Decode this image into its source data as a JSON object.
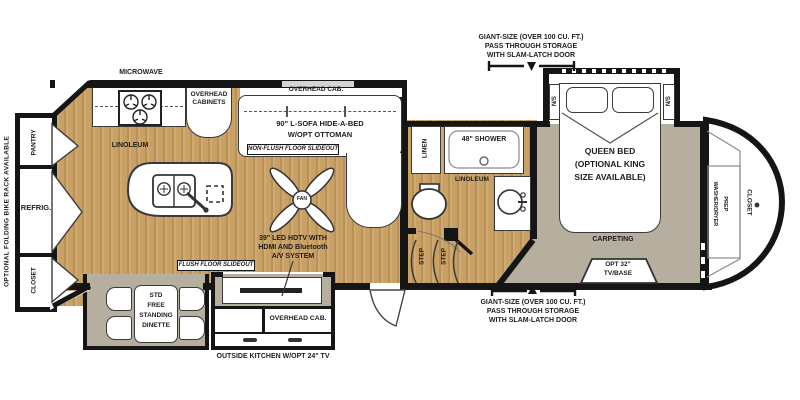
{
  "labels": {
    "microwave": "MICROWAVE",
    "overhead_cabinets_1": "OVERHEAD",
    "overhead_cabinets_2": "CABINETS",
    "overhead_cab_sofa": "OVERHEAD CAB.",
    "sofa_1": "90\" L-SOFA HIDE-A-BED",
    "sofa_2": "W/OPT OTTOMAN",
    "non_flush_slideout": "NON-FLUSH FLOOR SLIDEOUT",
    "linoleum_kitchen": "LINOLEUM",
    "fan": "FAN",
    "pantry": "PANTRY",
    "refrig": "REFRIG.",
    "closet_rear": "CLOSET",
    "bike_rack": "OPTIONAL FOLDING BIKE RACK AVAILABLE",
    "dinette_1": "STD",
    "dinette_2": "FREE",
    "dinette_3": "STANDING",
    "dinette_4": "DINETTE",
    "flush_slideout": "FLUSH FLOOR SLIDEOUT",
    "tv_1": "39\" LED HDTV WITH",
    "tv_2": "HDMI AND Bluetooth",
    "tv_3": "A/V SYSTEM",
    "overhead_cab_outside": "OVERHEAD CAB.",
    "outside_kitchen": "OUTSIDE KITCHEN W/OPT 24\" TV",
    "linen": "LINEN",
    "shower": "48\" SHOWER",
    "linoleum_bath": "LINOLEUM",
    "step_1": "STEP",
    "step_2": "STEP",
    "ns_left": "N/S",
    "ns_right": "N/S",
    "queen_1": "QUEEN BED",
    "queen_2": "(OPTIONAL KING",
    "queen_3": "SIZE AVAILABLE)",
    "carpeting": "CARPETING",
    "opt_tv_1": "OPT 32\"",
    "opt_tv_2": "TV/BASE",
    "closet_front": "CLOSET",
    "washer_dryer_1": "WASHER/DRYER",
    "washer_dryer_2": "PREP",
    "storage_top_1": "GIANT-SIZE (OVER 100 CU. FT.)",
    "storage_top_2": "PASS THROUGH STORAGE",
    "storage_top_3": "WITH SLAM-LATCH DOOR",
    "storage_bottom_1": "GIANT-SIZE (OVER 100 CU. FT.)",
    "storage_bottom_2": "PASS THROUGH STORAGE",
    "storage_bottom_3": "WITH SLAM-LATCH DOOR"
  },
  "colors": {
    "wall": "#151515",
    "wood_floor": "#c9a164",
    "carpet": "#b6ae9f",
    "furniture_outline": "#3a3a3a"
  }
}
